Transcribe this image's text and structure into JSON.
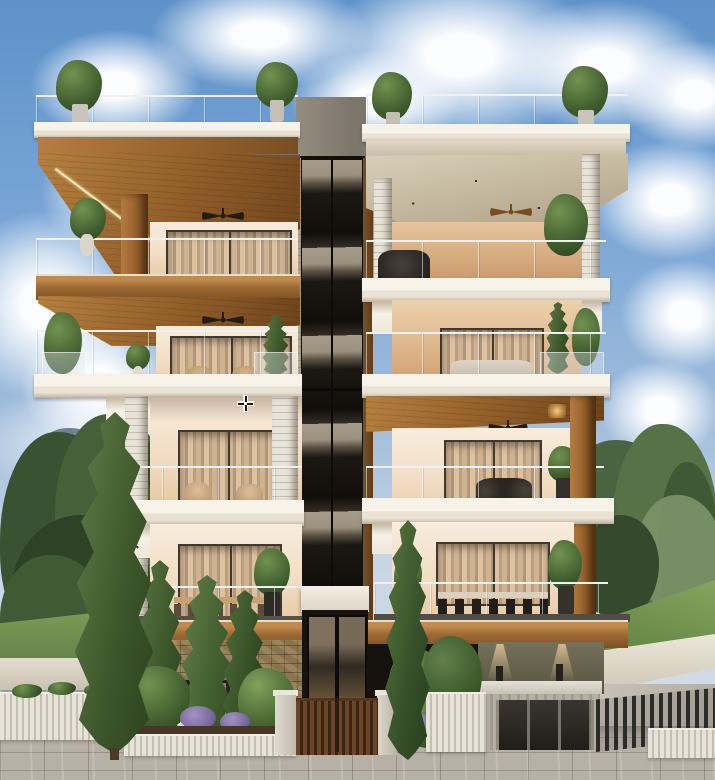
{
  "scene": {
    "description": "Photorealistic 3D exterior render of a modern four-storey residential apartment building, front street elevation, partly cloudy daytime sky",
    "style": "architectural visualization",
    "time_of_day": "day"
  },
  "cursor": {
    "type": "crosshair",
    "x": 245,
    "y": 403
  },
  "building": {
    "storeys": 4,
    "core": {
      "type": "central glazed stair and lift shaft",
      "cladding": "dark glass with timber trim",
      "cap_color": "#8d8578"
    },
    "wings": [
      {
        "side": "left",
        "soffits": "timber with LED strip lighting",
        "features": [
          "glass balustrades",
          "ceiling fans",
          "recessed downlights",
          "sheer-curtained sliding doors",
          "outdoor dining set",
          "potted plants",
          "roof terrace planters"
        ]
      },
      {
        "side": "right",
        "soffits": "limestone upper floors, timber pergola on second floor",
        "features": [
          "glass balustrades",
          "ceiling fans",
          "outdoor lounge seating",
          "black-chair dining set",
          "hanging plants"
        ]
      }
    ],
    "ground_level": [
      "rubble stone base wall with warm uplights",
      "timber slat entrance gate",
      "stone gate pillars",
      "glazed entry door under white canopy",
      "basement garage and driveway ramp",
      "dark metal picket fences",
      "white ribbed boundary walls"
    ]
  },
  "landscape": [
    "tall cypress trees",
    "pine and olive background trees",
    "garden beds with purple flowering shrubs",
    "green lawns",
    "grey paved sidewalk"
  ],
  "palette": {
    "sky_top": "#5e92c9",
    "sky_horizon": "#d7dfe6",
    "cloud": "#f4f6f8",
    "timber": "#a06c35",
    "timber_dark": "#6b421a",
    "limestone": "#d6cbb5",
    "slab_white": "#f7f3e9",
    "wall_cream": "#f4e6d4",
    "wall_tan": "#cf9f72",
    "core_glass": "#14110c",
    "core_cap": "#8d8578",
    "foliage_dark": "#2c3f1f",
    "foliage_mid": "#47613a",
    "foliage_light": "#6d8a4a",
    "lawn": "#6d8c49",
    "stone_base": "#8a7550",
    "paver": "#b7b0a7",
    "gate_timber": "#5b3b20",
    "fence_dark": "#26241f",
    "warm_light": "#ffd9a0"
  }
}
